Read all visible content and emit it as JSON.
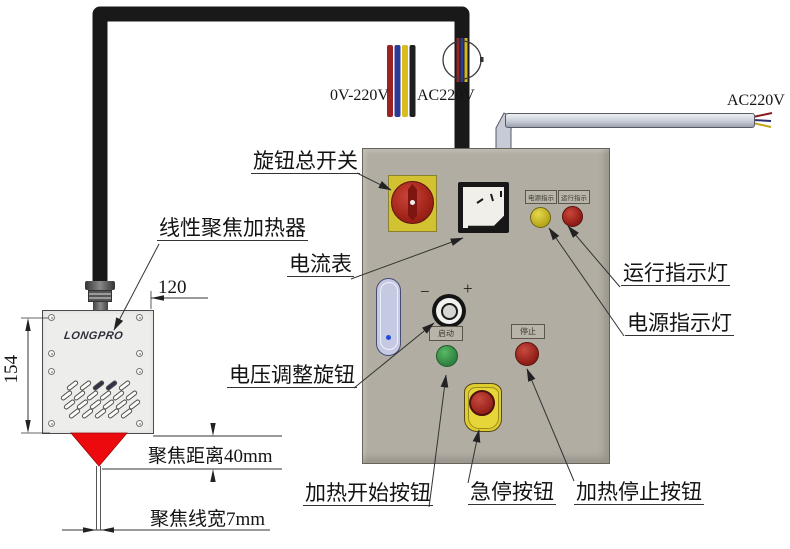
{
  "diagram": {
    "callouts": {
      "rotary_main_switch": "旋钮总开关",
      "linear_focus_heater": "线性聚焦加热器",
      "ammeter": "电流表",
      "voltage_adjust_knob": "电压调整旋钮",
      "run_indicator_light": "运行指示灯",
      "power_indicator_light": "电源指示灯",
      "heat_start_button": "加热开始按钮",
      "emergency_stop_button": "急停按钮",
      "heat_stop_button": "加热停止按钮"
    },
    "panel_tags": {
      "power_indicator": "电源指示",
      "run_indicator": "运行指示",
      "start": "启动",
      "stop": "停止",
      "knob_minus": "−",
      "knob_plus": "+"
    },
    "wiring": {
      "cable_output_label": "0V-220V",
      "cable_input_label": "AC220V",
      "mains_label": "AC220V"
    },
    "dimensions": {
      "heater_width": "120",
      "heater_height": "154",
      "focus_distance": "聚焦距离40mm",
      "focus_line_width": "聚焦线宽7mm"
    },
    "brand": "LONGPRO",
    "colors": {
      "panel_body": "#b2ada3",
      "estop_yellow": "#dfcd2f",
      "switch_red": "#a02318",
      "button_green": "#3f9e4e",
      "indicator_yellow": "#d6c52f",
      "indicator_red": "#b02a22",
      "cone_red": "#ec0a0e"
    }
  }
}
